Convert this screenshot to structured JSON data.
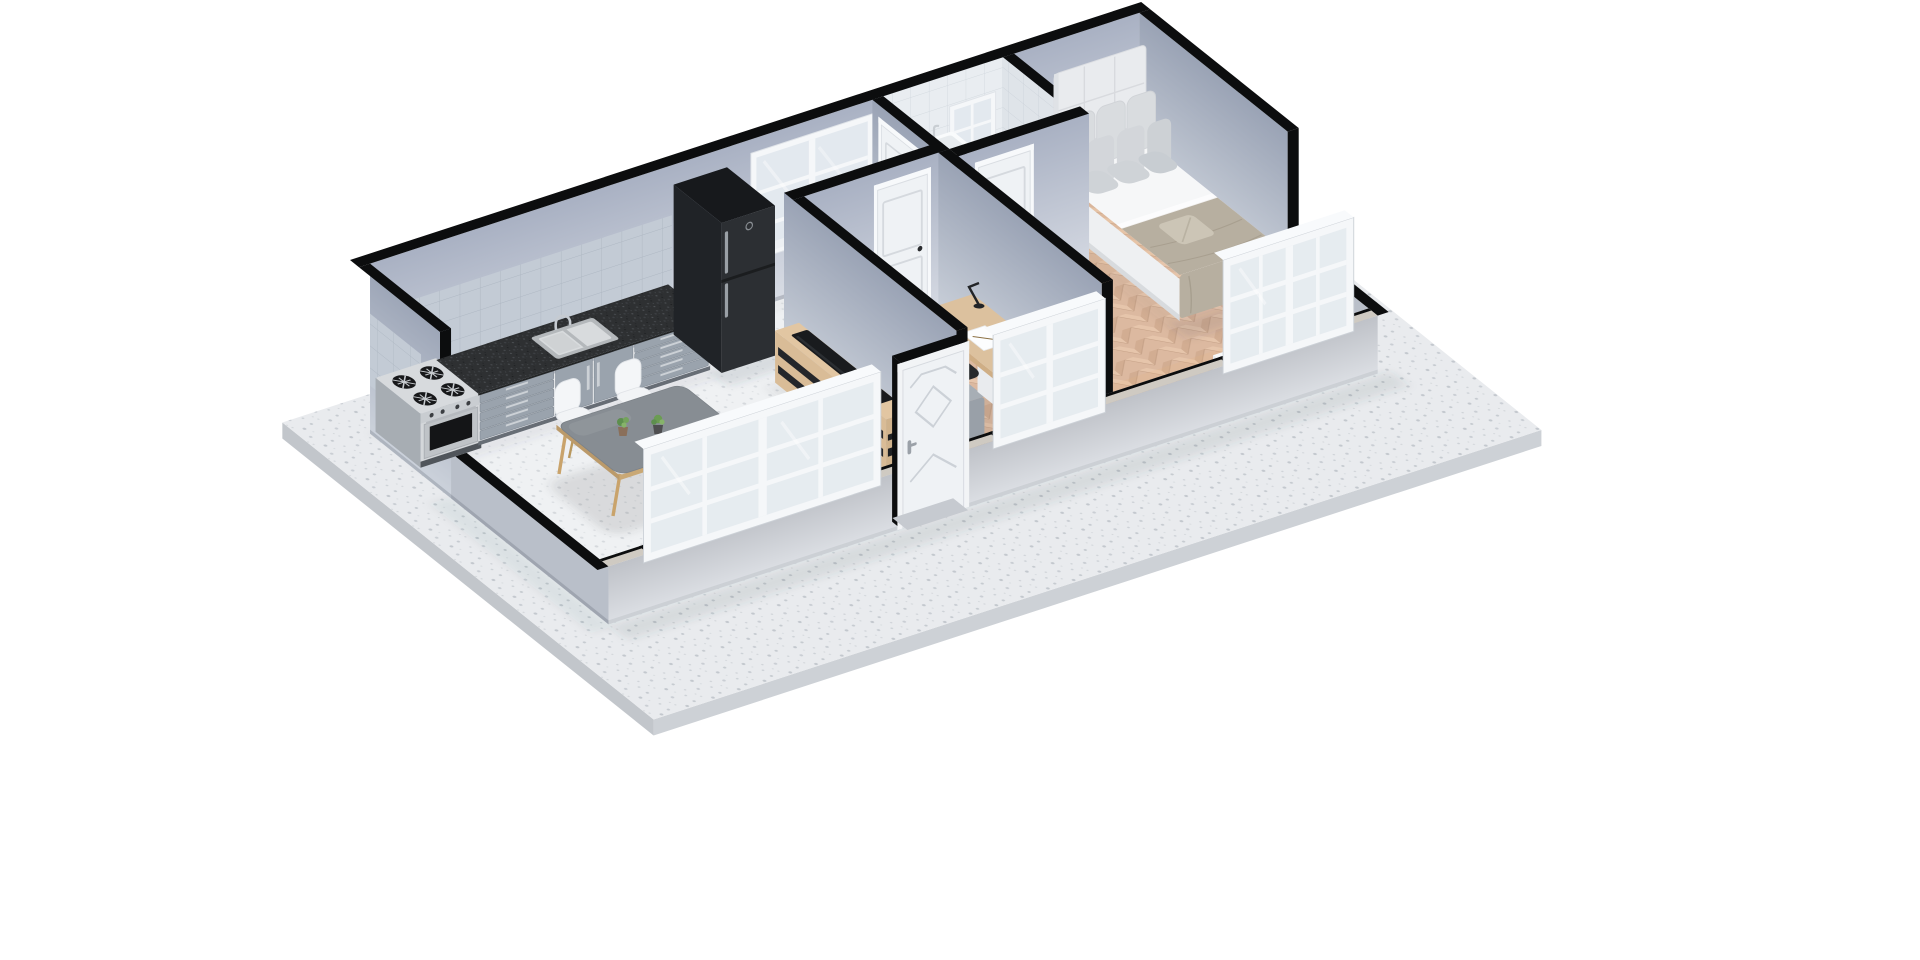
{
  "scene": {
    "kind": "3d-floorplan-cutaway-render",
    "background": "#ffffff",
    "view": "axonometric-top",
    "rooms": [
      {
        "id": "living-kitchen-dining",
        "furniture": [
          "gas-stove-oven",
          "kitchen-counter",
          "kitchen-sink",
          "refrigerator",
          "backsplash-tiles",
          "dining-table",
          "dining-chairs-x4",
          "potted-plants-x3",
          "tv-sideboard",
          "soundbar"
        ]
      },
      {
        "id": "hallway",
        "furniture": []
      },
      {
        "id": "bedroom-small",
        "furniture": [
          "single-bed",
          "nightstand",
          "table-lamp",
          "smartphone",
          "desk",
          "desk-lamp",
          "paper-sheets",
          "office-chair"
        ]
      },
      {
        "id": "bathroom",
        "furniture": [
          "vanity-cabinet",
          "vessel-sink",
          "faucet"
        ]
      },
      {
        "id": "bedroom-master",
        "furniture": [
          "double-bed",
          "tufted-headboard",
          "pillows-x8",
          "folded-accent-pillow",
          "nightstand",
          "table-lamp",
          "window-side-cabinet"
        ]
      }
    ],
    "openings": {
      "windows": [
        "hall-back-window",
        "bathroom-back-window",
        "living-front-window",
        "small-bedroom-front-window",
        "master-front-window"
      ],
      "doors": [
        "front-entrance-door",
        "bathroom-door",
        "small-bedroom-door",
        "master-bedroom-door"
      ]
    },
    "floors": {
      "living": "speckled-concrete",
      "bedrooms": "herringbone-oak",
      "bathroom": "gray-tile",
      "outside-slab": "speckled-terrazzo"
    }
  },
  "palette": {
    "bg": "#ffffff",
    "slab_top": "#e9ebee",
    "slab_side": "#cdd1d6",
    "floor_concrete": "#eff1f3",
    "wall_cut": "#0c0d0e",
    "facade_top": "#cfcac2",
    "window_frame": "#f5f7f9",
    "glass": "#e2e8ee",
    "door_white": "#eff2f5",
    "handle_dark": "#2a2c2f",
    "fridge": "#2c2f33",
    "counter_front": "#9aa3ad",
    "stove_steel": "#d4d7da",
    "cooktop_burner": "#17181a",
    "granite": "#2e3032",
    "tile_blue": "#c3cbd5",
    "tile_white": "#e8ecf0",
    "herring_base": "#dcb9a0",
    "table_top": "#878d93",
    "chair_shell": "#f2f4f6",
    "wood_leg": "#c9a36b",
    "wood_oak": "#d9bc97",
    "desk_top": "#dcc19e",
    "duvet_single": "#a7aeb5",
    "sheet_white": "#f6f7f8",
    "blanket_master": "#b7afa0",
    "pillow_gray": "#d9dcdf",
    "headboard": "#e9ebee",
    "vanity_dark": "#413c3d",
    "sink_white": "#f9fbfc",
    "nightstand_white": "#f2f4f6",
    "office_chair": "#27292c",
    "plant_green": "#5d8f4e",
    "lamp_glow": "#e8b36a"
  }
}
